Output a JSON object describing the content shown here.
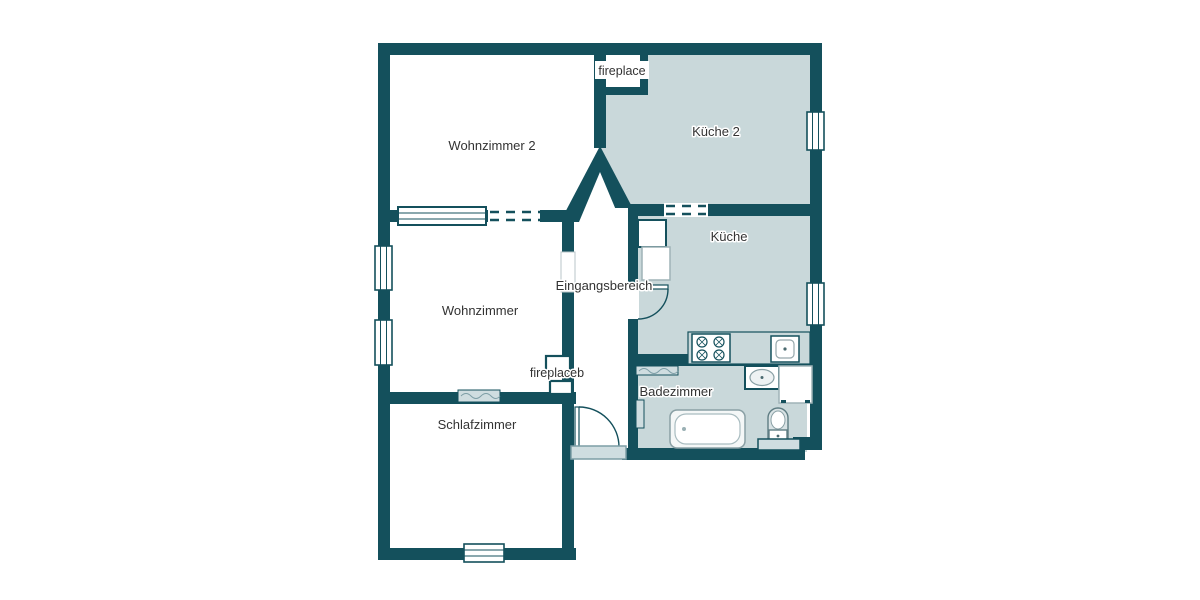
{
  "floorplan": {
    "type": "apartment-floor-plan",
    "background": "#ffffff",
    "colors": {
      "wall": "#14505c",
      "shaded_room_fill": "#c9d8da",
      "white_room_fill": "#ffffff",
      "fixture_fill": "#cfdde0",
      "fixture_stroke": "#8aa5ab",
      "label_text": "#333333"
    },
    "rooms": [
      {
        "id": "wohnzimmer-2",
        "label": "Wohnzimmer 2",
        "fill": "white"
      },
      {
        "id": "kueche-2",
        "label": "Küche 2",
        "fill": "shaded"
      },
      {
        "id": "kueche",
        "label": "Küche",
        "fill": "shaded"
      },
      {
        "id": "eingangsbereich",
        "label": "Eingangsbereich",
        "fill": "white"
      },
      {
        "id": "wohnzimmer",
        "label": "Wohnzimmer",
        "fill": "white"
      },
      {
        "id": "badezimmer",
        "label": "Badezimmer",
        "fill": "shaded"
      },
      {
        "id": "schlafzimmer",
        "label": "Schlafzimmer",
        "fill": "white"
      }
    ],
    "annotations": [
      {
        "id": "fireplace",
        "label": "fireplace"
      },
      {
        "id": "fireplaceb",
        "label": "fireplaceb"
      }
    ],
    "fixtures": [
      "stove-icon",
      "kitchen-sink-icon",
      "fridge-icon",
      "cupboard-icon",
      "bathtub-icon",
      "washbasin-icon",
      "pedestal-sink-icon",
      "washer-icon",
      "radiator-icon",
      "door-swing-icon",
      "window-icon",
      "doorstep-icon"
    ]
  }
}
